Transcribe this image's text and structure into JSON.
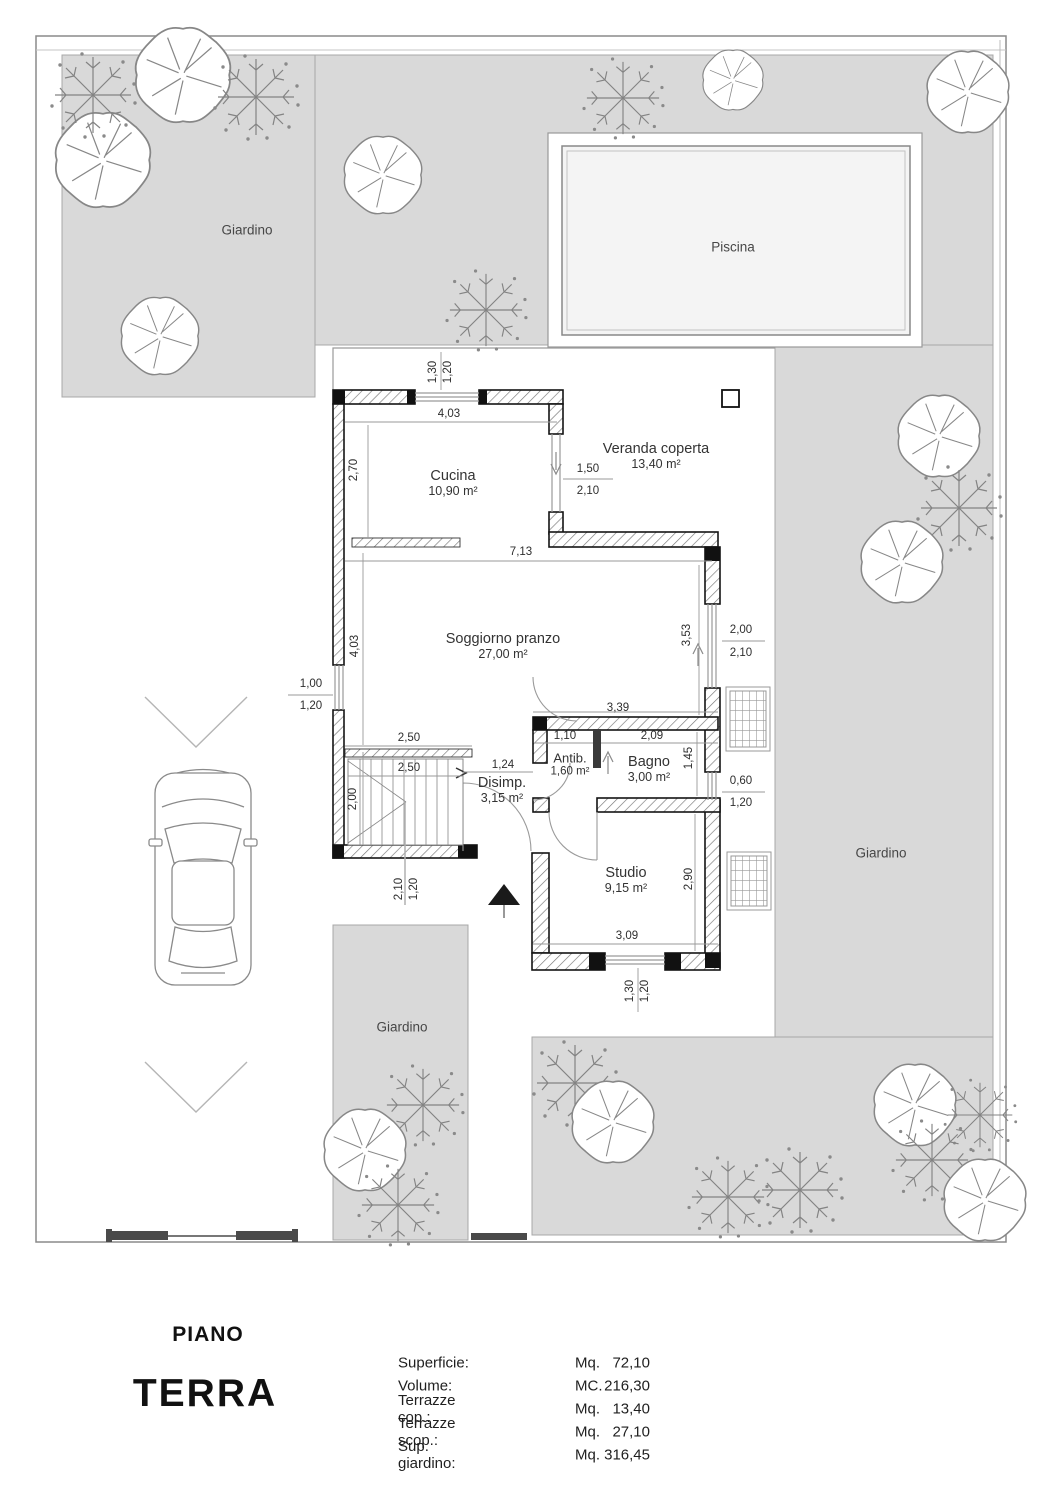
{
  "title": {
    "line1": "PIANO",
    "line2": "TERRA"
  },
  "legend": {
    "rows": [
      {
        "label": "Superficie:",
        "unit": "Mq.",
        "value": "72,10"
      },
      {
        "label": "Volume:",
        "unit": "MC.",
        "value": "216,30"
      },
      {
        "label": "Terrazze cop.:",
        "unit": "Mq.",
        "value": "13,40"
      },
      {
        "label": "Terrazze scop.:",
        "unit": "Mq.",
        "value": "27,10"
      },
      {
        "label": "Sup. giardino:",
        "unit": "Mq.",
        "value": "316,45"
      }
    ]
  },
  "plan": {
    "areas": {
      "garden_top_left": "Giardino",
      "garden_right": "Giardino",
      "garden_bottom": "Giardino",
      "pool": "Piscina"
    },
    "rooms": {
      "cucina": {
        "name": "Cucina",
        "area": "10,90 m²"
      },
      "veranda": {
        "name": "Veranda coperta",
        "area": "13,40 m²"
      },
      "soggiorno": {
        "name": "Soggiorno pranzo",
        "area": "27,00 m²"
      },
      "disimpegno": {
        "name": "Disimp.",
        "area": "3,15 m²"
      },
      "antibagno": {
        "name": "Antib.",
        "area": "1,60 m²"
      },
      "bagno": {
        "name": "Bagno",
        "area": "3,00 m²"
      },
      "studio": {
        "name": "Studio",
        "area": "9,15 m²"
      }
    },
    "dimensions": [
      {
        "t": "1,30",
        "x": 433,
        "y": 372,
        "rot": true
      },
      {
        "t": "1,20",
        "x": 448,
        "y": 372,
        "rot": true
      },
      {
        "t": "4,03",
        "x": 449,
        "y": 414,
        "rot": false
      },
      {
        "t": "2,70",
        "x": 354,
        "y": 470,
        "rot": true
      },
      {
        "t": "1,50",
        "x": 588,
        "y": 469,
        "rot": false
      },
      {
        "t": "2,10",
        "x": 588,
        "y": 491,
        "rot": false
      },
      {
        "t": "7,13",
        "x": 521,
        "y": 552,
        "rot": false
      },
      {
        "t": "4,03",
        "x": 355,
        "y": 646,
        "rot": true
      },
      {
        "t": "3,53",
        "x": 687,
        "y": 635,
        "rot": true
      },
      {
        "t": "2,00",
        "x": 741,
        "y": 630,
        "rot": false
      },
      {
        "t": "2,10",
        "x": 741,
        "y": 653,
        "rot": false
      },
      {
        "t": "1,00",
        "x": 311,
        "y": 684,
        "rot": false
      },
      {
        "t": "1,20",
        "x": 311,
        "y": 706,
        "rot": false
      },
      {
        "t": "3,39",
        "x": 618,
        "y": 708,
        "rot": false
      },
      {
        "t": "2,50",
        "x": 409,
        "y": 738,
        "rot": false
      },
      {
        "t": "2,50",
        "x": 409,
        "y": 768,
        "rot": false
      },
      {
        "t": "1,10",
        "x": 565,
        "y": 736,
        "rot": false
      },
      {
        "t": "2,09",
        "x": 652,
        "y": 736,
        "rot": false
      },
      {
        "t": "1,24",
        "x": 503,
        "y": 765,
        "rot": false
      },
      {
        "t": "1,45",
        "x": 689,
        "y": 758,
        "rot": true
      },
      {
        "t": "2,00",
        "x": 353,
        "y": 799,
        "rot": true
      },
      {
        "t": "0,60",
        "x": 741,
        "y": 781,
        "rot": false
      },
      {
        "t": "1,20",
        "x": 741,
        "y": 803,
        "rot": false
      },
      {
        "t": "2,10",
        "x": 399,
        "y": 889,
        "rot": true
      },
      {
        "t": "1,20",
        "x": 414,
        "y": 889,
        "rot": true
      },
      {
        "t": "2,90",
        "x": 689,
        "y": 879,
        "rot": true
      },
      {
        "t": "3,09",
        "x": 627,
        "y": 936,
        "rot": false
      },
      {
        "t": "1,30",
        "x": 630,
        "y": 991,
        "rot": true
      },
      {
        "t": "1,20",
        "x": 645,
        "y": 991,
        "rot": true
      }
    ]
  },
  "colors": {
    "garden": "#d9d9d9",
    "wall_stroke": "#141414",
    "pool_fill": "#f4f4f4"
  }
}
